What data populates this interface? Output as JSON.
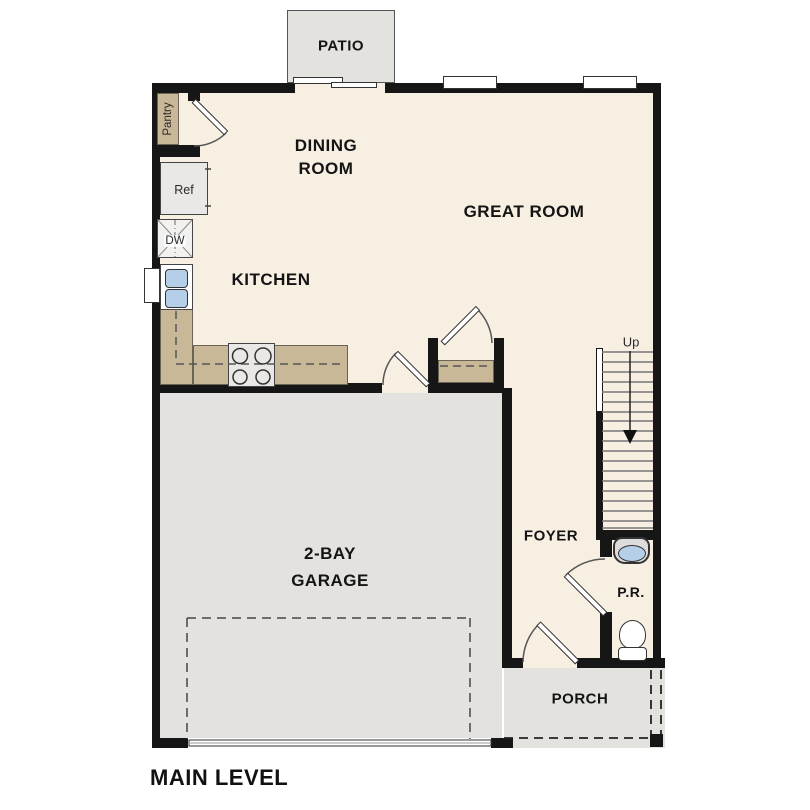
{
  "page": {
    "title": "MAIN LEVEL"
  },
  "rooms": {
    "patio": "PATIO",
    "dining_line1": "DINING",
    "dining_line2": "ROOM",
    "great": "GREAT ROOM",
    "kitchen": "KITCHEN",
    "garage_line1": "2-BAY",
    "garage_line2": "GARAGE",
    "foyer": "FOYER",
    "powder_room": "P.R.",
    "porch": "PORCH"
  },
  "fixtures": {
    "pantry": "Pantry",
    "refrigerator": "Ref",
    "dishwasher": "DW"
  },
  "stairs": {
    "direction": "Up"
  },
  "colors": {
    "wall": "#161616",
    "floor": "#f7efe2",
    "garage_floor": "#e3e2df",
    "counter": "#c9b897",
    "appliance": "#e9e8e6",
    "water_fixture": "#b5cfe9",
    "background": "#ffffff"
  }
}
